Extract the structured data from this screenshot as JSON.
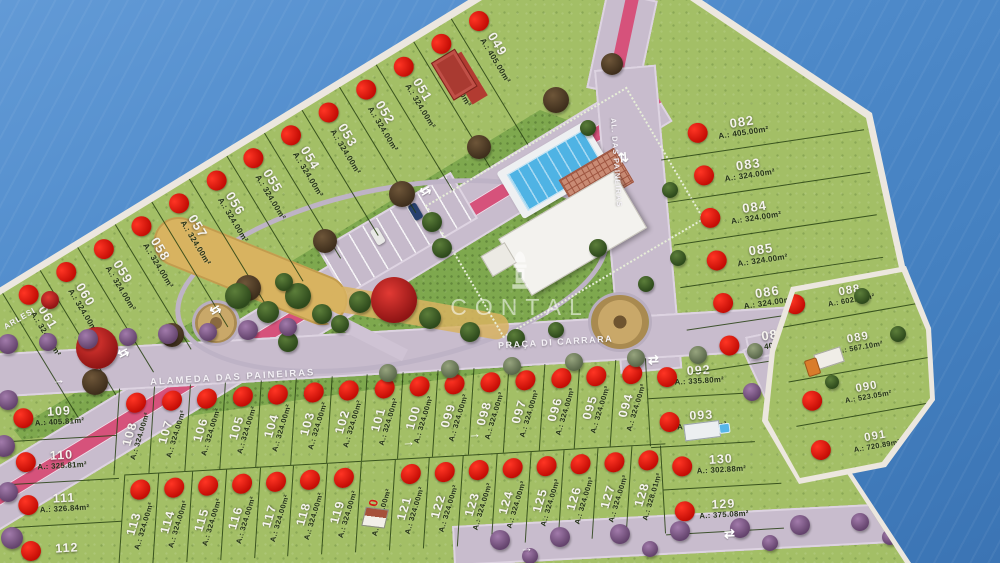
{
  "watermark": {
    "text": "CONTAL"
  },
  "street_labels": {
    "alameda": "ALAMEDA DAS PAINEIRAS",
    "praca": "PRAÇA DI CARRARA",
    "right_road": "AL. DAS PAINEIRAS",
    "left_road_partial": "ARLESI"
  },
  "icons": {
    "two_way_arrow": "⇆",
    "two_way_arrow_v": "⇅",
    "two_way_arrow_h": "⇄",
    "arrow_right": "→"
  },
  "colors": {
    "water": "#4e8aca",
    "grass": "#a3bf66",
    "park": "#7ea84e",
    "road": "#c8bccd",
    "bike_lane": "#d6527b",
    "sold_dot": "#d81410"
  },
  "lot_groups": {
    "top_strip": [
      {
        "num": "061",
        "area": "A.: 324.00m²",
        "sold": true
      },
      {
        "num": "060",
        "area": "A.: 324.00m²",
        "sold": true
      },
      {
        "num": "059",
        "area": "A.: 324.00m²",
        "sold": true
      },
      {
        "num": "058",
        "area": "A.: 324.00m²",
        "sold": true
      },
      {
        "num": "057",
        "area": "A.: 324.00m²",
        "sold": true
      },
      {
        "num": "056",
        "area": "A.: 324.00m²",
        "sold": true
      },
      {
        "num": "055",
        "area": "A.: 324.00m²",
        "sold": true
      },
      {
        "num": "054",
        "area": "A.: 324.00m²",
        "sold": true
      },
      {
        "num": "053",
        "area": "A.: 324.00m²",
        "sold": true
      },
      {
        "num": "052",
        "area": "A.: 324.00m²",
        "sold": true
      },
      {
        "num": "051",
        "area": "A.: 324.00m²",
        "sold": true
      },
      {
        "num": "050",
        "area": "A.: 324.00m²",
        "sold": true,
        "on_red": true,
        "marker": "sales"
      },
      {
        "num": "049",
        "area": "A.: 405.00m²",
        "sold": true
      }
    ],
    "right_column": [
      {
        "num": "082",
        "area": "A.: 405.00m²",
        "sold": true
      },
      {
        "num": "083",
        "area": "A.: 324.00m²",
        "sold": true
      },
      {
        "num": "084",
        "area": "A.: 324.00m²",
        "sold": true
      },
      {
        "num": "085",
        "area": "A.: 324.00m²",
        "sold": true
      },
      {
        "num": "086",
        "area": "A.: 324.00m²",
        "sold": true
      },
      {
        "num": "087",
        "area": "A.: 405.00m²",
        "sold": true
      }
    ],
    "block_ne": [
      {
        "num": "088",
        "area": "A.: 602.63m²",
        "sold": true
      },
      {
        "num": "089",
        "area": "A.: 567.10m²",
        "sold": false,
        "marker": "house-truck"
      },
      {
        "num": "090",
        "area": "A.: 523.05m²",
        "sold": true
      },
      {
        "num": "091",
        "area": "A.: 720.89m²",
        "sold": true
      }
    ],
    "row1": [
      {
        "num": "108",
        "area": "A.: 324.00m²",
        "sold": true
      },
      {
        "num": "107",
        "area": "A.: 324.00m²",
        "sold": true
      },
      {
        "num": "106",
        "area": "A.: 324.00m²",
        "sold": true
      },
      {
        "num": "105",
        "area": "A.: 324.00m²",
        "sold": true
      },
      {
        "num": "104",
        "area": "A.: 324.00m²",
        "sold": true
      },
      {
        "num": "103",
        "area": "A.: 324.00m²",
        "sold": true
      },
      {
        "num": "102",
        "area": "A.: 324.00m²",
        "sold": true
      },
      {
        "num": "101",
        "area": "A.: 324.00m²",
        "sold": true
      },
      {
        "num": "100",
        "area": "A.: 324.00m²",
        "sold": true
      },
      {
        "num": "099",
        "area": "A.: 324.00m²",
        "sold": true
      },
      {
        "num": "098",
        "area": "A.: 324.00m²",
        "sold": true
      },
      {
        "num": "097",
        "area": "A.: 324.00m²",
        "sold": true
      },
      {
        "num": "096",
        "area": "A.: 324.00m²",
        "sold": true
      },
      {
        "num": "095",
        "area": "A.: 324.00m²",
        "sold": true
      },
      {
        "num": "094",
        "area": "A.: 324.00m²",
        "sold": true
      }
    ],
    "row2": [
      {
        "num": "113",
        "area": "A.: 324.00m²",
        "sold": true
      },
      {
        "num": "114",
        "area": "A.: 324.00m²",
        "sold": true
      },
      {
        "num": "115",
        "area": "A.: 324.00m²",
        "sold": true
      },
      {
        "num": "116",
        "area": "A.: 324.00m²",
        "sold": true
      },
      {
        "num": "117",
        "area": "A.: 324.00m²",
        "sold": true
      },
      {
        "num": "118",
        "area": "A.: 324.00m²",
        "sold": true
      },
      {
        "num": "119",
        "area": "A.: 324.00m²",
        "sold": true
      },
      {
        "num": "120",
        "area": "A.: 324.00m²",
        "sold": false,
        "red_number": true,
        "marker": "house-car"
      },
      {
        "num": "121",
        "area": "A.: 324.00m²",
        "sold": true
      },
      {
        "num": "122",
        "area": "A.: 324.00m²",
        "sold": true
      },
      {
        "num": "123",
        "area": "A.: 324.00m²",
        "sold": true
      },
      {
        "num": "124",
        "area": "A.: 324.00m²",
        "sold": true
      },
      {
        "num": "125",
        "area": "A.: 324.00m²",
        "sold": true
      },
      {
        "num": "126",
        "area": "A.: 324.00m²",
        "sold": true
      },
      {
        "num": "127",
        "area": "A.: 324.00m²",
        "sold": true
      },
      {
        "num": "128",
        "area": "A.: 328.01m²",
        "sold": true
      }
    ],
    "end_block_1": [
      {
        "num": "092",
        "area": "A.: 335.80m²",
        "sold": true
      },
      {
        "num": "093",
        "area": "A.: 344.56m²",
        "sold": true,
        "marker": "house-pool"
      }
    ],
    "end_block_2": [
      {
        "num": "130",
        "area": "A.: 302.88m²",
        "sold": true
      },
      {
        "num": "129",
        "area": "A.: 375.08m²",
        "sold": true
      }
    ],
    "left_block": [
      {
        "num": "109",
        "area": "A.: 405.81m²",
        "sold": true
      },
      {
        "num": "110",
        "area": "A.: 325.81m²",
        "sold": true
      },
      {
        "num": "111",
        "area": "A.: 326.84m²",
        "sold": true
      },
      {
        "num": "112",
        "area": "",
        "sold": true
      }
    ]
  }
}
